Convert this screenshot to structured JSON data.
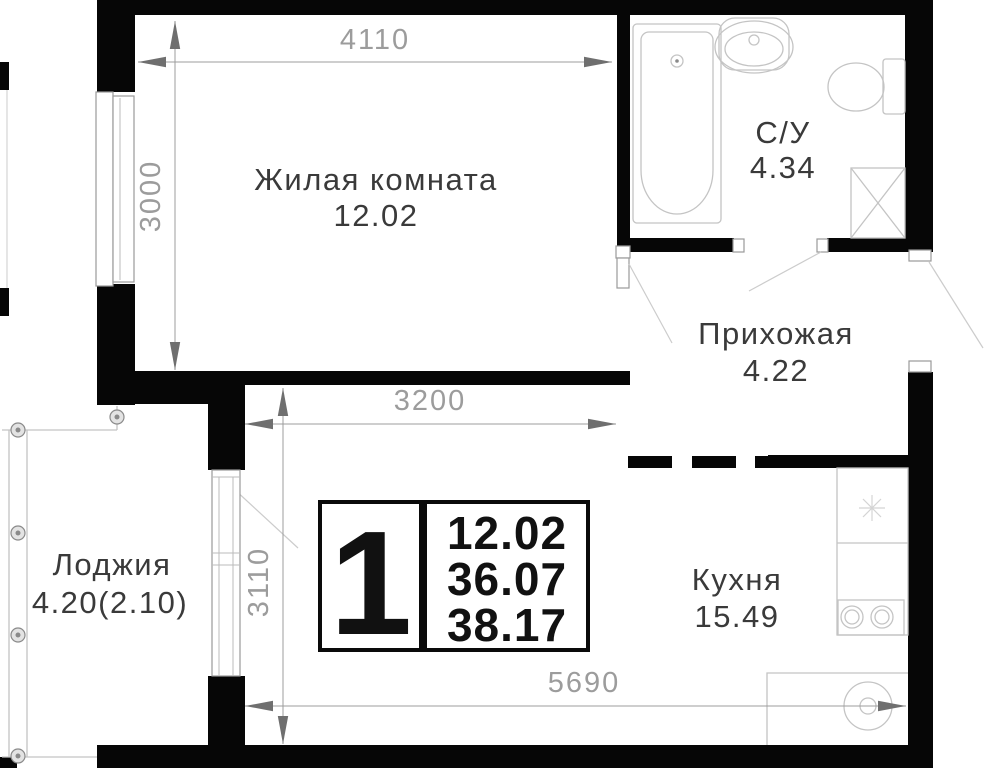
{
  "floorplan": {
    "rooms": [
      {
        "key": "living",
        "name": "Жилая комната",
        "area": "12.02"
      },
      {
        "key": "bathroom",
        "name": "С/У",
        "area": "4.34"
      },
      {
        "key": "hallway",
        "name": "Прихожая",
        "area": "4.22"
      },
      {
        "key": "kitchen",
        "name": "Кухня",
        "area": "15.49"
      },
      {
        "key": "loggia",
        "name": "Лоджия",
        "area": "4.20(2.10)"
      }
    ],
    "dimensions_mm": [
      {
        "key": "living-width",
        "value": "4110",
        "orientation": "horizontal"
      },
      {
        "key": "living-height",
        "value": "3000",
        "orientation": "vertical"
      },
      {
        "key": "kitchen-width",
        "value": "3200",
        "orientation": "horizontal"
      },
      {
        "key": "kitchen-height",
        "value": "3110",
        "orientation": "vertical"
      },
      {
        "key": "bottom-width",
        "value": "5690",
        "orientation": "horizontal"
      }
    ],
    "info_box": {
      "rooms_count": "1",
      "living_area": "12.02",
      "area_without_loggia": "36.07",
      "total_area": "38.17"
    },
    "icons": [
      "bathtub-icon",
      "bath-sink-icon",
      "toilet-icon",
      "washing-machine-icon",
      "stove-icon",
      "kitchen-sink-icon",
      "vent-icon",
      "loggia-post-icon"
    ],
    "colors": {
      "wall": "#060606",
      "dimension_line": "#9c9c9c",
      "dimension_arrow": "#6f6f6f",
      "room_label": "#3a3a3a",
      "fixture_outline": "#c4c4c4",
      "background": "#ffffff"
    }
  }
}
